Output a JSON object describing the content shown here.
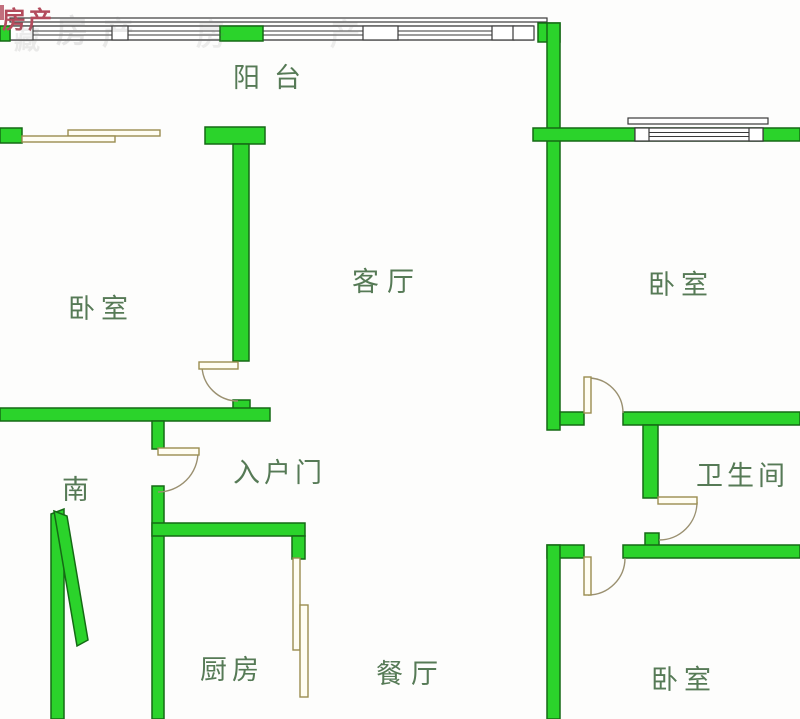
{
  "title": "户型图",
  "watermark": {
    "red_text": "房产",
    "ghost_char_1": "房",
    "ghost_char_2": "产",
    "ghost_char_3": "藏",
    "ghost_char_4": "房",
    "ghost_char_5": "产"
  },
  "labels": {
    "balcony": "阳台",
    "bedroom_left": "卧室",
    "living_room": "客厅",
    "bedroom_right": "卧室",
    "south": "南",
    "entrance_door": "入户门",
    "bathroom": "卫生间",
    "kitchen": "厨房",
    "dining_room": "餐厅",
    "bedroom_bottom": "卧室"
  },
  "colors": {
    "wall_fill": "#2bd32b",
    "wall_outline": "#156a15",
    "label_text": "#567a56",
    "door_outline": "#9a8d50",
    "door_fill": "#fffdf2",
    "line_dark": "#3a3a3a",
    "arc_color": "#9a9070",
    "watermark_red": "#b34b5c",
    "bg": "#fdfdfc"
  }
}
